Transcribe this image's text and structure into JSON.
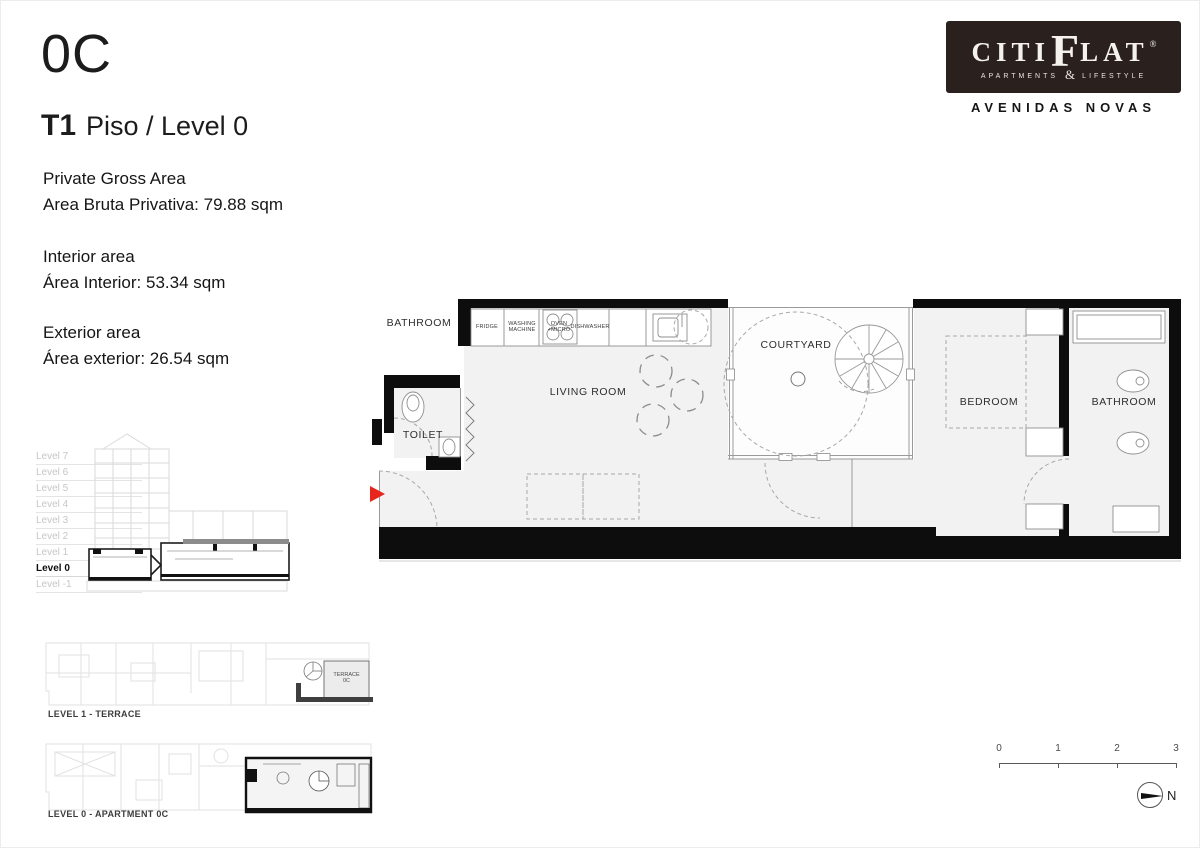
{
  "header": {
    "unit": "0C",
    "typology": "T1",
    "floor": "Piso / Level 0",
    "areas": {
      "gross_en": "Private Gross Area",
      "gross_pt": "Area Bruta Privativa: 79.88 sqm",
      "interior_en": "Interior area",
      "interior_pt": "Área Interior: 53.34 sqm",
      "exterior_en": "Exterior area",
      "exterior_pt": "Área exterior: 26.54 sqm"
    }
  },
  "logo": {
    "brand_left": "CITI",
    "brand_f": "F",
    "brand_right": "LAT",
    "registered": "®",
    "sub_left": "APARTMENTS",
    "amp": "&",
    "sub_right": "LIFESTYLE",
    "location": "AVENIDAS NOVAS"
  },
  "section": {
    "levels": [
      "Level 7",
      "Level 6",
      "Level 5",
      "Level 4",
      "Level 3",
      "Level 2",
      "Level 1",
      "Level 0",
      "Level -1"
    ],
    "active_level": "Level 0"
  },
  "plan": {
    "labels": {
      "bathroom_left": "BATHROOM",
      "toilet": "TOILET",
      "living_room": "LIVING ROOM",
      "courtyard": "COURTYARD",
      "bedroom": "BEDROOM",
      "bathroom_right": "BATHROOM"
    },
    "appliances": {
      "fridge": "FRIDGE",
      "washing_machine": "WASHING\nMACHINE",
      "oven_micro": "OVEN\n+MICRO",
      "dishwasher": "DISHWASHER"
    }
  },
  "mini_plans": {
    "terrace_caption": "LEVEL 1 - TERRACE",
    "terrace_highlight": "TERRACE\n0C",
    "apartment_caption": "LEVEL 0 - APARTMENT 0C"
  },
  "scale_bar": {
    "ticks": [
      "0",
      "1",
      "2",
      "3"
    ]
  },
  "north_label": "N",
  "colors": {
    "accent_red": "#e8251d",
    "logo_bg": "#2a211e",
    "wall_ink": "#0d0d0d",
    "floor_fill": "#f2f2f2"
  }
}
